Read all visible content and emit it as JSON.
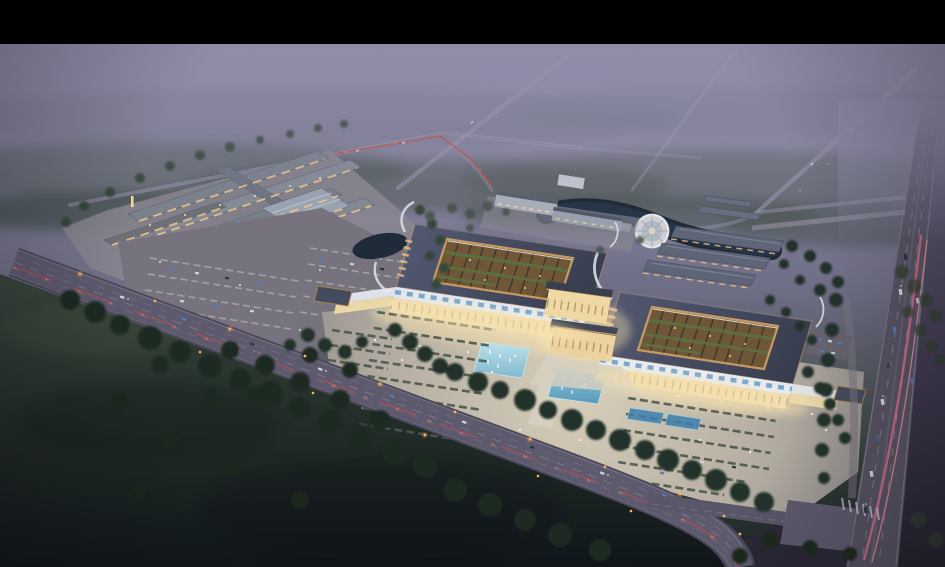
{
  "scene": {
    "type": "aerial-architectural-rendering",
    "description": "Dusk aerial rendering of a large illuminated Chinese-style exhibition and market complex: two huge curved-eave halls with lit courtyards joined by a warm-lit central gate, a forecourt plaza with cyan fountain pools and green planter rows, a secondary market complex with a big parking lot at left, ponds and a circular fountain plaza behind, rows of low outbuildings, dark tree belts and fields, a diagonal avenue with orange street lamps and a multi-lane highway with pink light trails at right, all under a lavender haze with a black letterbox bar at top.",
    "time_of_day": "dusk",
    "letterbox": {
      "position": "top",
      "height_px": 44,
      "color": "#000000"
    }
  },
  "palette": {
    "bar-black": "#000000",
    "sky-top": "#8f8ca8",
    "sky-mid": "#7e7c97",
    "haze-lavender": "#8d8aa7",
    "forest-haze": "#4c5851",
    "tree-dark": "#24322a",
    "tree-mid": "#35463a",
    "field-dark": "#141a1a",
    "road-asphalt": "#5e5a6e",
    "road-edge": "#8d8a9a",
    "highway": "#575364",
    "trail-pink": "#e0708c",
    "tail-red": "#c84a52",
    "lamp-orange": "#ffb25c",
    "plaza-light": "#d8cfba",
    "plaza-warm": "#f6e2ae",
    "roof-slate": "#454b5e",
    "copper": "#c89a63",
    "courtyard-amber": "#6e5637",
    "courtyard-green": "#5d7040",
    "colonnade-white": "#e9edf2",
    "canopy-blue": "#6f9fc8",
    "facade-warm": "#f0dcab",
    "water-dark": "#1f2b38",
    "pool-cyan": "#5fa8c8",
    "glow-white": "#fff6d6",
    "car-blue": "#4f7cc0",
    "car-white": "#cdd6e0",
    "car-dark": "#2e3440"
  },
  "regions": {
    "top": "black letterbox bar",
    "upper": "lavender haze, distant forest, diagonal roads with tail-light streak",
    "left": "market complex with lit stalls and large parking lot",
    "center": "twin curved-roof halls, central gate, fountain forecourt plaza",
    "behind": "canal ponds, circular fountain plaza, rows of outbuildings, office block",
    "bottom_left": "dark field with tree clusters",
    "bottom": "tree-lined avenue with orange lamps and cars",
    "right": "multi-lane highway with pink light trails and junction"
  }
}
